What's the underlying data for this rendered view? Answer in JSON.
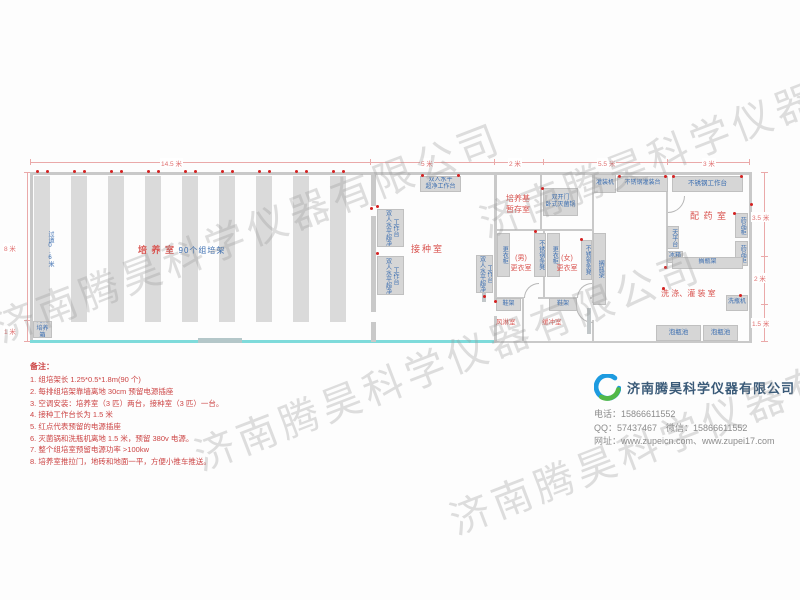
{
  "watermark": "济南腾昊科学仪器有限公司",
  "colors": {
    "room_label_red": "#d9534f",
    "equipment_blue": "#3a6db0",
    "dimension_red": "#e07070",
    "outlet_dot_red": "#d42222",
    "teal_wall": "#7fdbdb",
    "company_name_blue": "#3a5a78"
  },
  "plan": {
    "dims": {
      "top": [
        "14.5 米",
        "5 米",
        "2 米",
        "5.5 米",
        "3 米"
      ],
      "left": [
        "8 米",
        "1 米"
      ],
      "right": [
        "3.5 米",
        "2 米",
        "1.5 米"
      ]
    },
    "rooms": {
      "culture": "培 养 室",
      "culture_racks": "90个组培架",
      "aisle": "过道0.6米",
      "inoculation": "接种室",
      "medium_storage": "培养基\n暂存室",
      "mens": "(男)\n更衣室",
      "womens": "(女)\n更衣室",
      "air_shower": "风淋室",
      "buffer": "缓冲室",
      "dispensing": "配 药 室",
      "washing": "洗 涤、灌 装 室"
    },
    "equipment": {
      "incubator": "光照\n培养箱",
      "bench_top": "双人水平\n超净工作台",
      "bench_v": "双人水平超净工作台",
      "autoclave": "双开门\n卧式灭菌锅",
      "wardrobe": "更衣柜",
      "ss_bench": "不锈钢条凳",
      "bottle_rack": "搁瓶架",
      "shoe_rack": "鞋架",
      "filling_machine": "灌装机",
      "filling_table": "不锈钢灌装台",
      "work_table": "不锈钢工作台",
      "med_cabinet": "药品柜",
      "balance": "天平台",
      "fridge": "冰箱",
      "washer": "洗瓶机",
      "pool": "泡瓶池"
    }
  },
  "notes": {
    "title": "备注：",
    "items": [
      "1. 组培架长 1.25*0.5*1.8m(90 个)",
      "2. 每排组培架靠墙离地 30cm 预留电源插座",
      "3. 空调安装：培养室（3 匹）两台，接种室（3 匹）一台。",
      "4. 接种工作台长为 1.5 米",
      "5. 红点代表预留的电源插座",
      "6. 灭菌锅和洗瓶机离地 1.5 米，预留 380v 电源。",
      "7. 整个组培室预留电源功率 >100kw",
      "8. 培养室推拉门，地砖和地面一平，方便小推车推送。"
    ]
  },
  "company": {
    "name": "济南腾昊科学仪器有限公司",
    "phone": "电话：15866611552",
    "qq_wechat": "QQ：57437467　微信：15866611552",
    "web": "网址：www.zupeicn.com、www.zupei17.com"
  }
}
